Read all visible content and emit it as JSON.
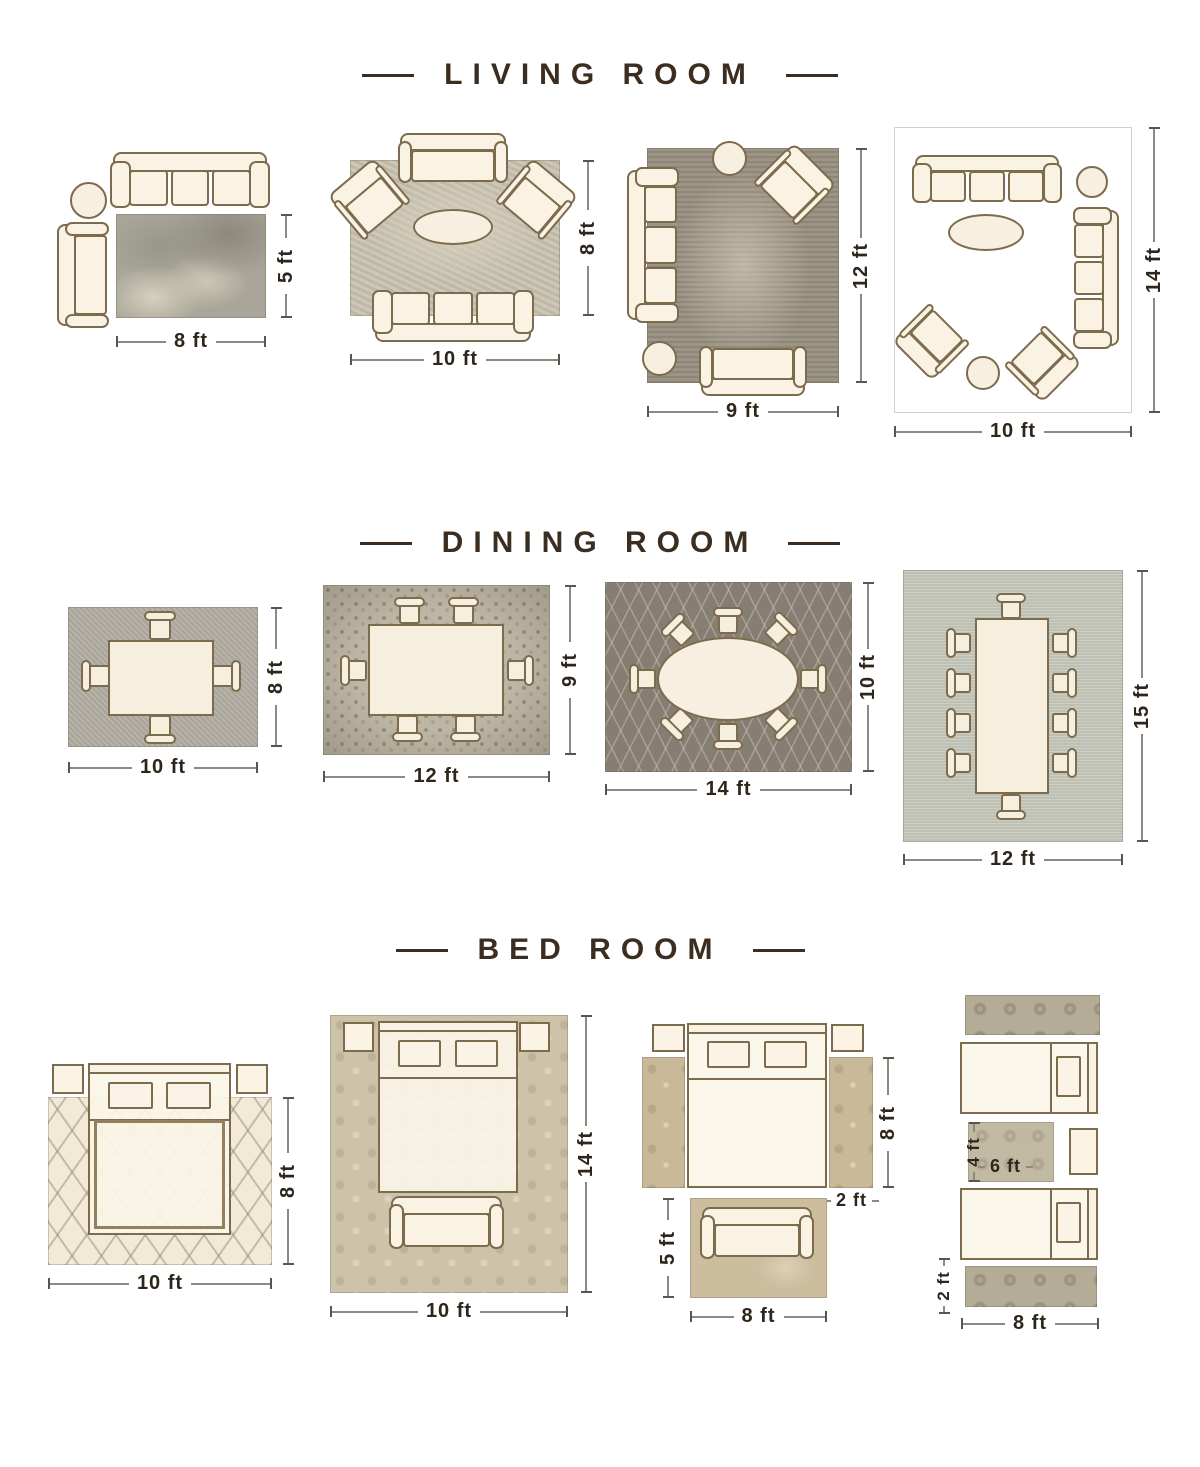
{
  "colors": {
    "header_text": "#3b2e20",
    "dimension_text": "#2e261c",
    "furniture_fill": "#faf2e3",
    "furniture_outline": "#7d6b4e",
    "background": "#ffffff"
  },
  "sections": [
    {
      "title": "LIVING ROOM",
      "layouts": [
        {
          "name": "5x8 rug with sofa and chaise",
          "dims": {
            "width": "8 ft",
            "height": "5 ft"
          }
        },
        {
          "name": "8x10 rug with sofa, loveseat, two armchairs",
          "dims": {
            "width": "10 ft",
            "height": "8 ft"
          }
        },
        {
          "name": "9x12 rug with sofa, loveseat, armchair",
          "dims": {
            "width": "9 ft",
            "height": "12 ft"
          }
        },
        {
          "name": "10x14 rug with two sofas, two armchairs",
          "dims": {
            "width": "10 ft",
            "height": "14 ft"
          }
        }
      ]
    },
    {
      "title": "DINING ROOM",
      "layouts": [
        {
          "name": "8x10 rug, table with 4 chairs",
          "dims": {
            "width": "10 ft",
            "height": "8 ft"
          }
        },
        {
          "name": "9x12 rug, table with 6 chairs",
          "dims": {
            "width": "12 ft",
            "height": "9 ft"
          }
        },
        {
          "name": "10x14 rug, oval table with 8 chairs",
          "dims": {
            "width": "14 ft",
            "height": "10 ft"
          }
        },
        {
          "name": "12x15 rug, table with 10 chairs",
          "dims": {
            "width": "12 ft",
            "height": "15 ft"
          }
        }
      ]
    },
    {
      "title": "BED ROOM",
      "layouts": [
        {
          "name": "8x10 rug under queen bed",
          "dims": {
            "width": "10 ft",
            "height": "8 ft"
          }
        },
        {
          "name": "10x14 rug under bed with bench",
          "dims": {
            "width": "10 ft",
            "height": "14 ft"
          }
        },
        {
          "name": "bedside runners and 5x8 rug",
          "dims": {
            "runner_height": "8 ft",
            "runner_width": "2 ft",
            "rug_height": "5 ft",
            "rug_width": "8 ft"
          }
        },
        {
          "name": "twin beds with runners and 4x6 rug",
          "dims": {
            "rug_height": "4 ft",
            "rug_width": "6 ft",
            "runner_height": "2 ft",
            "runner_width": "8 ft"
          }
        }
      ]
    }
  ]
}
